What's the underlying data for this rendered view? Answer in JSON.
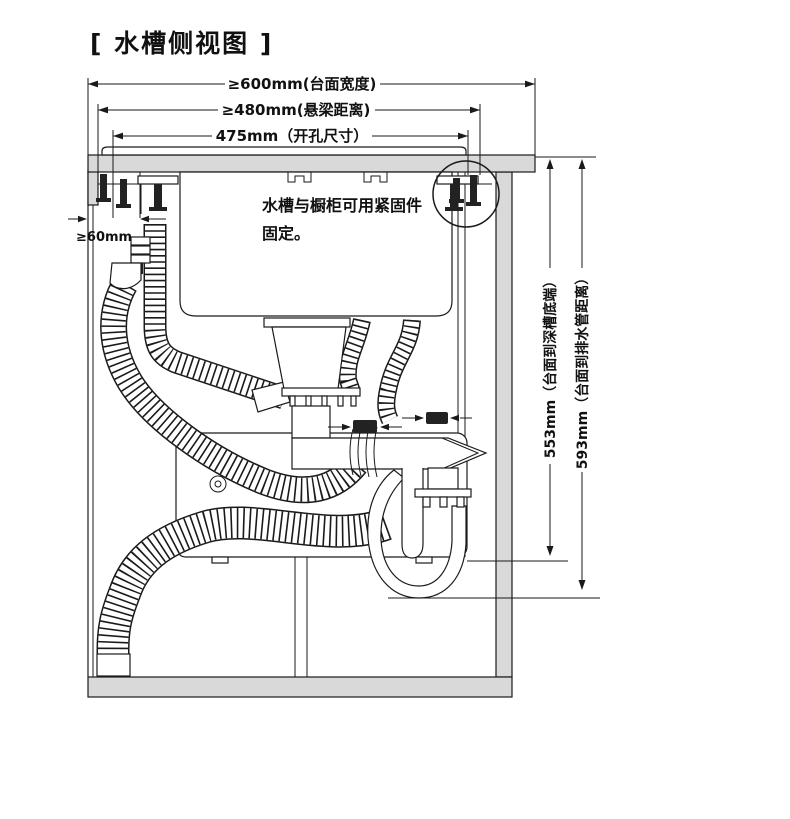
{
  "title": "[ 水槽侧视图 ]",
  "note": {
    "line1": "水槽与橱柜可用紧固件",
    "line2": "固定。"
  },
  "dimensions": {
    "countertop_width": "≥600mm(台面宽度)",
    "beam_distance": "≥480mm(悬梁距离)",
    "cutout_size": "475mm（开孔尺寸）",
    "side_clearance": "≥60mm",
    "depth_to_basin_bottom": "553mm（台面到深槽底端）",
    "depth_to_drain_pipe": "593mm（台面到排水管距离）"
  },
  "colors": {
    "line": "#1a1a1a",
    "panel": "#d9d9d9",
    "background": "#ffffff"
  }
}
